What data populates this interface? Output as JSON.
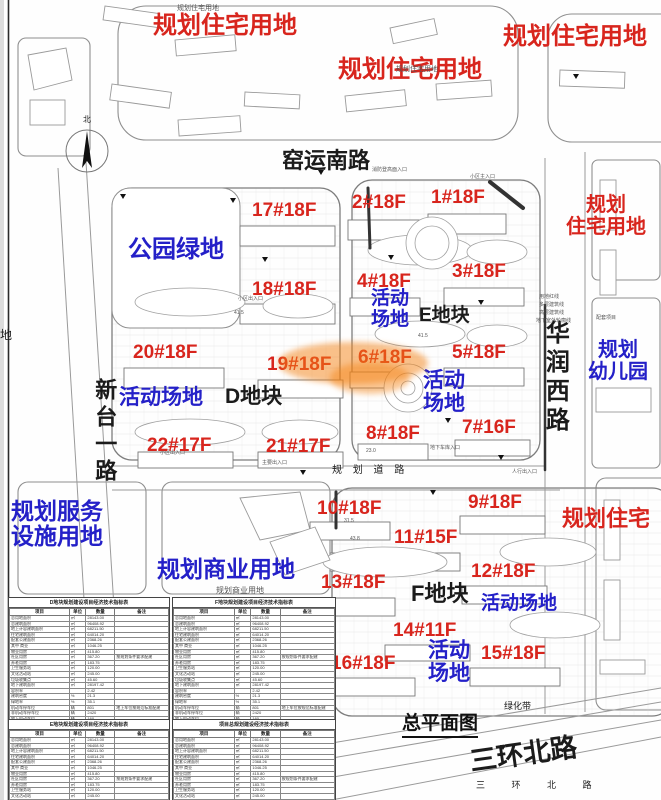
{
  "title": "总平面图",
  "colors": {
    "red": "#d8251d",
    "blue": "#2420c8",
    "black": "#1b1b1b",
    "gray": "#555555",
    "orange": "rgba(243,130,20,0.55)"
  },
  "labels": [
    {
      "n": "area-label-residential-1",
      "t": "规划住宅用地",
      "x": 153,
      "y": 13,
      "s": 24,
      "c": "red",
      "b": 1
    },
    {
      "n": "area-label-residential-2",
      "t": "规划住宅用地",
      "x": 338,
      "y": 57,
      "s": 24,
      "c": "red",
      "b": 1
    },
    {
      "n": "area-label-residential-3",
      "t": "规划住宅用地",
      "x": 503,
      "y": 24,
      "s": 24,
      "c": "red",
      "b": 1
    },
    {
      "n": "area-label-residential-4",
      "t": "规划\n住宅用地",
      "x": 551,
      "y": 194,
      "s": 20,
      "c": "red",
      "b": 1,
      "w": 110
    },
    {
      "n": "area-label-residential-5",
      "t": "规划住宅",
      "x": 562,
      "y": 507,
      "s": 22,
      "c": "red",
      "b": 1
    },
    {
      "n": "area-label-park",
      "t": "公园绿地",
      "x": 128,
      "y": 237,
      "s": 24,
      "c": "blue",
      "b": 1
    },
    {
      "n": "area-label-activity-e",
      "t": "活动\n场地",
      "x": 362,
      "y": 289,
      "s": 19,
      "c": "blue",
      "b": 1,
      "w": 56
    },
    {
      "n": "area-label-activity-d",
      "t": "活动场地",
      "x": 119,
      "y": 386,
      "s": 21,
      "c": "blue",
      "b": 1
    },
    {
      "n": "area-label-activity-center",
      "t": "活动\n场地",
      "x": 414,
      "y": 369,
      "s": 21,
      "c": "blue",
      "b": 1,
      "w": 60
    },
    {
      "n": "area-label-kindergarten",
      "t": "规划\n幼儿园",
      "x": 580,
      "y": 339,
      "s": 20,
      "c": "blue",
      "b": 1,
      "w": 76
    },
    {
      "n": "area-label-service",
      "t": "规划服务\n设施用地",
      "x": 11,
      "y": 499,
      "s": 23,
      "c": "blue",
      "b": 1
    },
    {
      "n": "area-label-commercial",
      "t": "规划商业用地",
      "x": 157,
      "y": 557,
      "s": 23,
      "c": "blue",
      "b": 1
    },
    {
      "n": "area-label-activity-f1",
      "t": "活动场地",
      "x": 481,
      "y": 594,
      "s": 19,
      "c": "blue",
      "b": 1
    },
    {
      "n": "area-label-activity-f2",
      "t": "活动\n场地",
      "x": 420,
      "y": 639,
      "s": 21,
      "c": "blue",
      "b": 1,
      "w": 58
    },
    {
      "n": "road-label-yaoyun-south",
      "t": "窑运南路",
      "x": 282,
      "y": 149,
      "s": 22,
      "c": "black",
      "b": 1
    },
    {
      "n": "block-label-d",
      "t": "D地块",
      "x": 225,
      "y": 385,
      "s": 21,
      "c": "black",
      "b": 1
    },
    {
      "n": "block-label-e",
      "t": "E地块",
      "x": 419,
      "y": 306,
      "s": 19,
      "c": "black",
      "b": 1
    },
    {
      "n": "block-label-f",
      "t": "F地块",
      "x": 411,
      "y": 582,
      "s": 22,
      "c": "black",
      "b": 1
    },
    {
      "n": "road-label-sanhuan-north",
      "t": "三环北路",
      "x": 468,
      "y": 748,
      "s": 27,
      "c": "black",
      "b": 1,
      "r": -8
    },
    {
      "n": "road-label-xintai-yi",
      "t": "新台一路",
      "x": 92,
      "y": 378,
      "s": 22,
      "c": "black",
      "b": 1,
      "v": 1,
      "h": 130
    },
    {
      "n": "road-label-huarun-west",
      "t": "华润西路",
      "x": 541,
      "y": 320,
      "s": 24,
      "c": "black",
      "b": 1,
      "v": 1,
      "h": 170
    },
    {
      "n": "road-label-planned-road",
      "t": "规 划 道 路",
      "x": 332,
      "y": 465,
      "s": 10,
      "c": "black",
      "ls": 4
    },
    {
      "n": "road-label-sanhuan-small",
      "t": "三 环 北 路",
      "x": 476,
      "y": 781,
      "s": 9,
      "c": "black",
      "ls": 12
    },
    {
      "n": "label-green-belt",
      "t": "绿化带",
      "x": 504,
      "y": 702,
      "s": 9,
      "c": "black"
    },
    {
      "n": "label-di-edge",
      "t": "地",
      "x": 0,
      "y": 329,
      "s": 12,
      "c": "black"
    },
    {
      "n": "label-north",
      "t": "北",
      "x": 83,
      "y": 116,
      "s": 8,
      "c": "black"
    },
    {
      "n": "small-label-residential-1",
      "t": "规划住宅用地",
      "x": 177,
      "y": 5,
      "s": 7,
      "c": "gray"
    },
    {
      "n": "small-label-residential-2",
      "t": "规划住宅用地",
      "x": 396,
      "y": 66,
      "s": 7,
      "c": "gray"
    },
    {
      "n": "small-label-commercial",
      "t": "规划商业用地",
      "x": 216,
      "y": 587,
      "s": 8,
      "c": "gray"
    },
    {
      "n": "tiny-fire-access",
      "t": "消防登高面入口",
      "x": 372,
      "y": 168,
      "s": 5,
      "c": "gray"
    },
    {
      "n": "tiny-main-entrance-1",
      "t": "小区主入口",
      "x": 470,
      "y": 175,
      "s": 5,
      "c": "gray"
    },
    {
      "n": "tiny-entrance-1",
      "t": "小区出入口",
      "x": 238,
      "y": 297,
      "s": 5,
      "c": "gray"
    },
    {
      "n": "tiny-entrance-2",
      "t": "小区出入口",
      "x": 160,
      "y": 451,
      "s": 5,
      "c": "gray"
    },
    {
      "n": "tiny-garage-entry",
      "t": "地下车库入口",
      "x": 430,
      "y": 446,
      "s": 5,
      "c": "gray"
    },
    {
      "n": "tiny-main-entry",
      "t": "主要出入口",
      "x": 262,
      "y": 461,
      "s": 5,
      "c": "gray"
    },
    {
      "n": "tiny-ped-entry",
      "t": "人行出入口",
      "x": 512,
      "y": 470,
      "s": 5,
      "c": "gray"
    },
    {
      "n": "tiny-support-facility",
      "t": "配套项目",
      "x": 596,
      "y": 316,
      "s": 5,
      "c": "gray"
    },
    {
      "n": "tiny-legend-redline",
      "t": "用地红线",
      "x": 539,
      "y": 295,
      "s": 5,
      "c": "gray"
    },
    {
      "n": "tiny-legend-multi",
      "t": "多层建筑线",
      "x": 539,
      "y": 303,
      "s": 5,
      "c": "gray"
    },
    {
      "n": "tiny-legend-high",
      "t": "高层建筑线",
      "x": 539,
      "y": 311,
      "s": 5,
      "c": "gray"
    },
    {
      "n": "tiny-legend-basement",
      "t": "地下室外轮廓线",
      "x": 536,
      "y": 319,
      "s": 5,
      "c": "gray"
    },
    {
      "n": "tiny-elev-1",
      "t": "41.5",
      "x": 234,
      "y": 311,
      "s": 5,
      "c": "gray"
    },
    {
      "n": "tiny-elev-2",
      "t": "41.5",
      "x": 418,
      "y": 334,
      "s": 5,
      "c": "gray"
    },
    {
      "n": "tiny-elev-3",
      "t": "23.0",
      "x": 366,
      "y": 449,
      "s": 5,
      "c": "gray"
    },
    {
      "n": "tiny-elev-4",
      "t": "43.8",
      "x": 350,
      "y": 537,
      "s": 5,
      "c": "gray"
    },
    {
      "n": "tiny-elev-5",
      "t": "31.5",
      "x": 344,
      "y": 519,
      "s": 5,
      "c": "gray"
    }
  ],
  "buildings": [
    {
      "t": "17#18F",
      "x": 252,
      "y": 200
    },
    {
      "t": "2#18F",
      "x": 352,
      "y": 192
    },
    {
      "t": "1#18F",
      "x": 431,
      "y": 187
    },
    {
      "t": "18#18F",
      "x": 252,
      "y": 279
    },
    {
      "t": "4#18F",
      "x": 357,
      "y": 271
    },
    {
      "t": "3#18F",
      "x": 452,
      "y": 261
    },
    {
      "t": "20#18F",
      "x": 133,
      "y": 342
    },
    {
      "t": "19#18F",
      "x": 267,
      "y": 354
    },
    {
      "t": "6#18F",
      "x": 358,
      "y": 347
    },
    {
      "t": "5#18F",
      "x": 452,
      "y": 342
    },
    {
      "t": "22#17F",
      "x": 147,
      "y": 435
    },
    {
      "t": "21#17F",
      "x": 266,
      "y": 436
    },
    {
      "t": "8#18F",
      "x": 366,
      "y": 423
    },
    {
      "t": "7#16F",
      "x": 462,
      "y": 417
    },
    {
      "t": "9#18F",
      "x": 468,
      "y": 492
    },
    {
      "t": "10#18F",
      "x": 317,
      "y": 498
    },
    {
      "t": "11#15F",
      "x": 394,
      "y": 527
    },
    {
      "t": "12#18F",
      "x": 471,
      "y": 561
    },
    {
      "t": "13#18F",
      "x": 321,
      "y": 572
    },
    {
      "t": "14#11F",
      "x": 393,
      "y": 620
    },
    {
      "t": "15#18F",
      "x": 481,
      "y": 643
    },
    {
      "t": "16#18F",
      "x": 331,
      "y": 653
    }
  ],
  "tables": {
    "headers": [
      "项目",
      "单位",
      "数量",
      "备注"
    ],
    "shared_rows": [
      [
        "总用地面积",
        "㎡",
        "28143.00",
        ""
      ],
      [
        "总建筑面积",
        "㎡",
        "96408.92",
        ""
      ],
      [
        "地上计容建筑面积",
        "㎡",
        "68211.50",
        ""
      ],
      [
        "住宅建筑面积",
        "㎡",
        "64014.20",
        ""
      ],
      [
        "配套公建面积",
        "㎡",
        "2368.26",
        ""
      ],
      [
        "其中 商业",
        "㎡",
        "1046.25",
        ""
      ],
      [
        "物业用房",
        "㎡",
        "415.80",
        ""
      ],
      [
        "社区用房",
        "㎡",
        "367.20",
        "按规划条件要求配建"
      ],
      [
        "养老用房",
        "㎡",
        "183.75",
        ""
      ],
      [
        "卫生服务站",
        "㎡",
        "120.00",
        ""
      ],
      [
        "文化活动站",
        "㎡",
        "245.00",
        ""
      ],
      [
        "垃圾收集点",
        "㎡",
        "45.60",
        ""
      ],
      [
        "地下建筑面积",
        "㎡",
        "28197.42",
        ""
      ],
      [
        "容积率",
        "",
        "2.42",
        ""
      ],
      [
        "建筑密度",
        "%",
        "21.3",
        ""
      ],
      [
        "绿地率",
        "%",
        "35.1",
        ""
      ],
      [
        "机动车停车位",
        "辆",
        "801",
        "地上车位按规范标准配建"
      ],
      [
        "非机动车停车位",
        "辆",
        "2420",
        ""
      ],
      [
        "地上机动车位",
        "辆",
        "160",
        ""
      ],
      [
        "建筑高度",
        "m",
        "54.00",
        "详见单体设计"
      ]
    ],
    "items": [
      {
        "n": "table-indicators-d",
        "t": "D地块规划建设项目经济技术指标表",
        "x": 8,
        "y": 597,
        "w": 160,
        "rows": 20
      },
      {
        "n": "table-indicators-e",
        "t": "E地块规划建设项目经济技术指标表",
        "x": 8,
        "y": 719,
        "w": 160,
        "rows": 13
      },
      {
        "n": "table-indicators-f",
        "t": "F地块规划建设项目经济技术指标表",
        "x": 172,
        "y": 597,
        "w": 162,
        "rows": 20
      },
      {
        "n": "table-indicators-total",
        "t": "项目总规划建设经济技术指标表",
        "x": 172,
        "y": 719,
        "w": 162,
        "rows": 13
      }
    ]
  }
}
